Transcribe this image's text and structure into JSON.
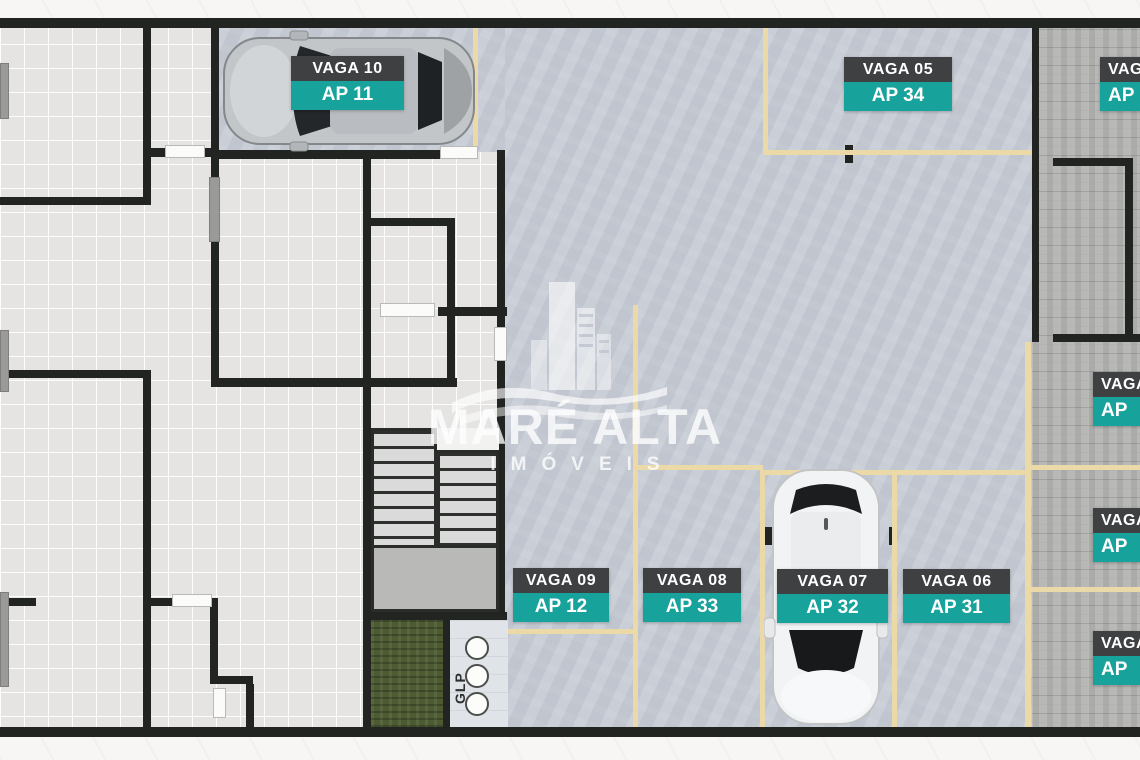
{
  "watermark": {
    "title": "MARÉ ALTA",
    "subtitle": "IMÓVEIS"
  },
  "annotations": {
    "glp": "GLP"
  },
  "colors": {
    "label_dark": "#3f4042",
    "teal": "#17a29b",
    "tan_line": "#ecd9a8",
    "parking_floor": "#c6cbd4",
    "tile_floor": "#e5e4e2",
    "wall": "#212421",
    "grass": "#4d5b32"
  },
  "parking_spots": [
    {
      "vaga": "VAGA 10",
      "ap": "AP 11",
      "x": 291,
      "y": 56,
      "w": 113,
      "cut": false
    },
    {
      "vaga": "VAGA 05",
      "ap": "AP 34",
      "x": 844,
      "y": 57,
      "w": 108,
      "cut": false
    },
    {
      "vaga": "VAGA",
      "ap": "AP",
      "x": 1100,
      "y": 57,
      "w": 90,
      "cut": true
    },
    {
      "vaga": "VAGA",
      "ap": "AP",
      "x": 1093,
      "y": 372,
      "w": 90,
      "cut": true
    },
    {
      "vaga": "VAGA",
      "ap": "AP",
      "x": 1093,
      "y": 508,
      "w": 90,
      "cut": true
    },
    {
      "vaga": "VAGA",
      "ap": "AP",
      "x": 1093,
      "y": 631,
      "w": 90,
      "cut": true
    },
    {
      "vaga": "VAGA 09",
      "ap": "AP 12",
      "x": 513,
      "y": 568,
      "w": 96,
      "cut": false
    },
    {
      "vaga": "VAGA 08",
      "ap": "AP 33",
      "x": 643,
      "y": 568,
      "w": 98,
      "cut": false
    },
    {
      "vaga": "VAGA 07",
      "ap": "AP 32",
      "x": 777,
      "y": 569,
      "w": 111,
      "cut": false
    },
    {
      "vaga": "VAGA 06",
      "ap": "AP 31",
      "x": 903,
      "y": 569,
      "w": 107,
      "cut": false
    }
  ]
}
